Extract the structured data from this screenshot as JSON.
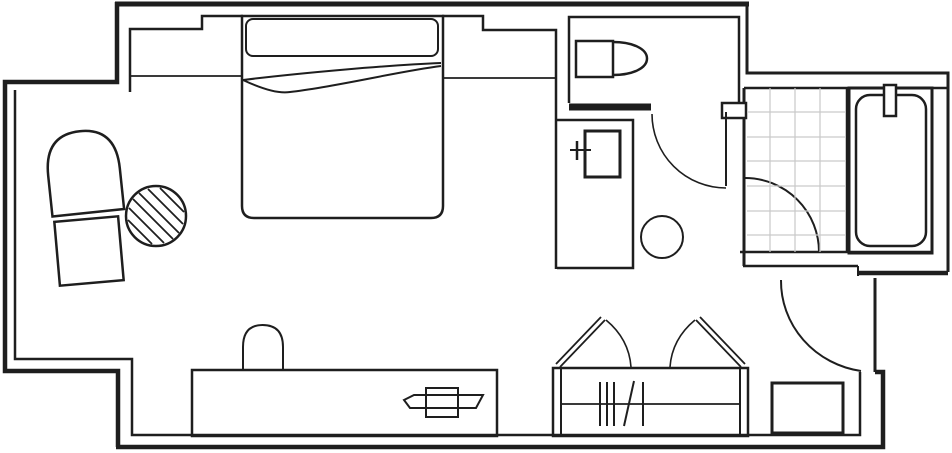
{
  "diagram": {
    "type": "floor-plan",
    "subject": "hotel-room-floor-plan",
    "canvas": {
      "width": 952,
      "height": 453
    },
    "palette": {
      "background": "#ffffff",
      "line": "#1e1e1e",
      "tile": "#c9c9c9",
      "white": "#ffffff"
    }
  },
  "shapes": [
    {
      "name": "wall-outer-top",
      "kind": "line",
      "x1": 115,
      "y1": 4,
      "x2": 749,
      "y2": 4,
      "sw": 5
    },
    {
      "name": "wall-outer-left",
      "kind": "path",
      "d": "M 117 2 V 82 H 5 V 371 H 118 V 447",
      "sw": 4.5
    },
    {
      "name": "wall-outer-bottom",
      "kind": "path",
      "d": "M 116 447 H 883 V 372 H 875",
      "sw": 4.5
    },
    {
      "name": "wall-entry-jamb",
      "kind": "line",
      "x1": 875,
      "y1": 372,
      "x2": 875,
      "y2": 278,
      "sw": 3
    },
    {
      "name": "wall-outer-top-right",
      "kind": "path",
      "d": "M 747 4 V 73 H 948 V 272",
      "sw": 3
    },
    {
      "name": "wall-entry-band-left",
      "kind": "line",
      "x1": 743,
      "y1": 266,
      "x2": 858,
      "y2": 266,
      "sw": 2.5
    },
    {
      "name": "wall-entry-band-right",
      "kind": "line",
      "x1": 858,
      "y1": 273,
      "x2": 948,
      "y2": 273,
      "sw": 4.5
    },
    {
      "name": "wall-entry-band-step",
      "kind": "line",
      "x1": 858,
      "y1": 266,
      "x2": 858,
      "y2": 276,
      "sw": 2
    },
    {
      "name": "wall-inner-left",
      "kind": "path",
      "d": "M 15 90 V 359 H 132 V 435 H 860 V 372",
      "sw": 2.5
    },
    {
      "name": "wall-inner-top-left",
      "kind": "path",
      "d": "M 130 92 V 29 H 202 V 16 H 243",
      "sw": 2.5
    },
    {
      "name": "wall-inner-top-right",
      "kind": "path",
      "d": "M 442 16 H 483 V 30 H 556 V 269",
      "sw": 2.5
    },
    {
      "name": "bed-ledge-left",
      "kind": "line",
      "x1": 130,
      "y1": 76,
      "x2": 242,
      "y2": 76,
      "sw": 1.8
    },
    {
      "name": "bed-ledge-right",
      "kind": "line",
      "x1": 443,
      "y1": 78,
      "x2": 556,
      "y2": 78,
      "sw": 1.8
    },
    {
      "name": "wall-bathroom-left",
      "kind": "line",
      "x1": 744,
      "y1": 88,
      "x2": 744,
      "y2": 266,
      "sw": 3
    },
    {
      "name": "wall-bathroom-top",
      "kind": "line",
      "x1": 744,
      "y1": 88,
      "x2": 947,
      "y2": 88,
      "sw": 2.5
    },
    {
      "name": "wall-bathroom-bottom",
      "kind": "line",
      "x1": 740,
      "y1": 252,
      "x2": 932,
      "y2": 252,
      "sw": 2.5
    },
    {
      "name": "wc-room",
      "kind": "path",
      "d": "M 569 103 V 17 H 739 V 103",
      "sw": 2.5
    },
    {
      "name": "wall-wc-bottom",
      "kind": "line",
      "x1": 569,
      "y1": 107,
      "x2": 651,
      "y2": 107,
      "sw": 7
    },
    {
      "name": "wall-door-pier",
      "kind": "rect",
      "x": 722,
      "y": 103,
      "w": 24,
      "h": 15,
      "sw": 2.5,
      "fill": "#ffffff"
    },
    {
      "name": "bath-door-leaf",
      "kind": "line",
      "x1": 726,
      "y1": 112,
      "x2": 726,
      "y2": 186,
      "sw": 2
    },
    {
      "name": "bath-door-arc",
      "kind": "path",
      "d": "M 652 114 A 74 74 0 0 0 726 188",
      "sw": 1.6
    },
    {
      "name": "shower-door-arc",
      "kind": "path",
      "d": "M 745 178 A 74 74 0 0 1 819 252",
      "sw": 2
    },
    {
      "name": "entry-door-arc",
      "kind": "path",
      "d": "M 781 280 A 94 91 0 0 0 861 371",
      "sw": 2
    },
    {
      "name": "shower-tile-grid",
      "kind": "grid",
      "x": 747,
      "y": 88,
      "w": 98,
      "h": 164,
      "vx": [
        770,
        795,
        820
      ],
      "hy": [
        112,
        137,
        161,
        186,
        211,
        235
      ],
      "stroke": "#c9c9c9",
      "sw": 1.2
    },
    {
      "name": "shower-tub-divider",
      "kind": "line",
      "x1": 847,
      "y1": 88,
      "x2": 847,
      "y2": 252,
      "sw": 2.5
    },
    {
      "name": "bathtub-outer",
      "kind": "rect",
      "x": 849,
      "y": 88,
      "w": 83,
      "h": 165,
      "sw": 3
    },
    {
      "name": "bathtub-inner",
      "kind": "rect",
      "x": 856,
      "y": 95,
      "w": 70,
      "h": 151,
      "rx": 14,
      "sw": 2.5
    },
    {
      "name": "bathtub-faucet",
      "kind": "rect",
      "x": 884,
      "y": 85,
      "w": 12,
      "h": 31,
      "sw": 2.5,
      "fill": "#ffffff"
    },
    {
      "name": "toilet-tank",
      "kind": "rect",
      "x": 576,
      "y": 41,
      "w": 37,
      "h": 36,
      "sw": 2.5,
      "fill": "#ffffff"
    },
    {
      "name": "toilet-bowl",
      "kind": "path",
      "d": "M 613 42 C 633 42 647 49 647 58.5 C 647 68 633 75 613 75",
      "sw": 2.5
    },
    {
      "name": "vanity-counter",
      "kind": "path",
      "d": "M 556 120 H 633 V 268 H 557",
      "sw": 2.5
    },
    {
      "name": "vanity-sink",
      "kind": "rect",
      "x": 585,
      "y": 131,
      "w": 35,
      "h": 46,
      "sw": 3
    },
    {
      "name": "sink-tap-horizontal",
      "kind": "line",
      "x1": 570,
      "y1": 150,
      "x2": 591,
      "y2": 150,
      "sw": 2
    },
    {
      "name": "sink-tap-vertical",
      "kind": "line",
      "x1": 577,
      "y1": 141,
      "x2": 577,
      "y2": 160,
      "sw": 2.5
    },
    {
      "name": "stool",
      "kind": "circle",
      "cx": 662,
      "cy": 237,
      "r": 21,
      "sw": 2
    },
    {
      "name": "bed",
      "kind": "path",
      "d": "M 242 16 H 443 V 206 Q 443 218 431 218 H 254 Q 242 218 242 206 Z",
      "sw": 2.5
    },
    {
      "name": "bed-headboard",
      "kind": "rect",
      "x": 246,
      "y": 19,
      "w": 192,
      "h": 37,
      "rx": 7,
      "sw": 2
    },
    {
      "name": "bed-blanket-fold-upper",
      "kind": "path",
      "d": "M 243 80 C 300 73 390 65 441 63",
      "sw": 2
    },
    {
      "name": "bed-blanket-fold-lower",
      "kind": "path",
      "d": "M 243 80 C 260 88 278 94 290 92 C 335 87 400 71 441 66",
      "sw": 2
    },
    {
      "name": "armchair",
      "kind": "path",
      "d": "M 48 213 H 120 V 172 Q 120 131 84 131 Q 48 131 48 172 Z",
      "sw": 2.5,
      "transform": "rotate(-6 84 172)"
    },
    {
      "name": "ottoman",
      "kind": "rect",
      "x": 57,
      "y": 219,
      "w": 64,
      "h": 64,
      "sw": 2.5,
      "transform": "rotate(-5 89 251)"
    },
    {
      "name": "side-table",
      "kind": "circle",
      "cx": 156,
      "cy": 216,
      "r": 30,
      "sw": 2.5
    },
    {
      "name": "side-table-hatch",
      "kind": "lines",
      "sw": 1.8,
      "segs": [
        [
          160,
          188,
          184,
          212
        ],
        [
          148,
          189,
          183,
          224
        ],
        [
          139,
          193,
          179,
          233
        ],
        [
          133,
          199,
          173,
          239
        ],
        [
          129,
          208,
          164,
          243
        ],
        [
          128,
          220,
          152,
          244
        ]
      ]
    },
    {
      "name": "desk",
      "kind": "rect",
      "x": 192,
      "y": 370,
      "w": 305,
      "h": 66,
      "sw": 2.5
    },
    {
      "name": "desk-chair",
      "kind": "path",
      "d": "M 243 371 V 347 Q 243 325 262.5 325 Q 283 325 283 347 V 371",
      "sw": 2
    },
    {
      "name": "tv",
      "kind": "polygon",
      "points": "404,400 414,395 483,395 476,408 410,408",
      "sw": 2
    },
    {
      "name": "tv-stand",
      "kind": "rect",
      "x": 426,
      "y": 388,
      "w": 32,
      "h": 29,
      "sw": 2
    },
    {
      "name": "closet",
      "kind": "rect",
      "x": 553,
      "y": 368,
      "w": 195,
      "h": 68,
      "sw": 2.5
    },
    {
      "name": "closet-side-left",
      "kind": "line",
      "x1": 561,
      "y1": 368,
      "x2": 561,
      "y2": 436,
      "sw": 2
    },
    {
      "name": "closet-side-right",
      "kind": "line",
      "x1": 740,
      "y1": 368,
      "x2": 740,
      "y2": 436,
      "sw": 2
    },
    {
      "name": "closet-rail",
      "kind": "line",
      "x1": 561,
      "y1": 404,
      "x2": 740,
      "y2": 404,
      "sw": 1.8
    },
    {
      "name": "closet-hangers",
      "kind": "lines",
      "sw": 2,
      "segs": [
        [
          600,
          382,
          600,
          426
        ],
        [
          607,
          382,
          607,
          426
        ],
        [
          614,
          382,
          614,
          426
        ],
        [
          624,
          426,
          634,
          381
        ],
        [
          643,
          382,
          643,
          426
        ]
      ]
    },
    {
      "name": "closet-door-left",
      "kind": "lines",
      "sw": 1.8,
      "segs": [
        [
          556,
          364,
          601,
          317
        ],
        [
          560,
          367,
          605,
          320
        ]
      ]
    },
    {
      "name": "closet-door-left-arc",
      "kind": "path",
      "d": "M 606 320 Q 629 339 631 367",
      "sw": 1.6
    },
    {
      "name": "closet-door-right",
      "kind": "lines",
      "sw": 1.8,
      "segs": [
        [
          745,
          364,
          700,
          317
        ],
        [
          741,
          367,
          696,
          320
        ]
      ]
    },
    {
      "name": "closet-door-right-arc",
      "kind": "path",
      "d": "M 695 320 Q 672 339 670 367",
      "sw": 1.6
    },
    {
      "name": "luggage-rack",
      "kind": "rect",
      "x": 772,
      "y": 383,
      "w": 71,
      "h": 50,
      "sw": 3
    }
  ]
}
